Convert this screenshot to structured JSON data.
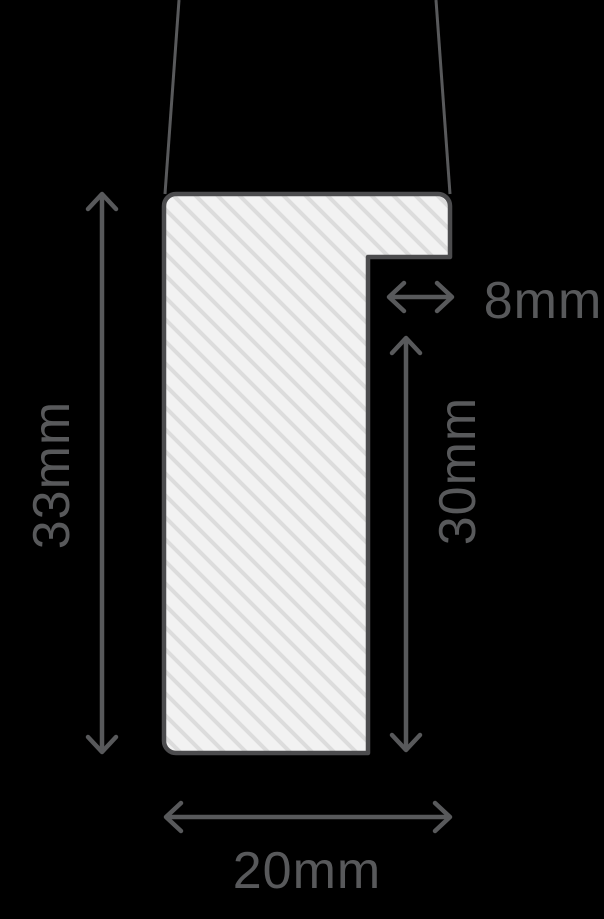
{
  "page": {
    "background_color": "#000000"
  },
  "diagram": {
    "name": "frame-moulding-profile-cross-section",
    "profile": {
      "fill_color": "#f2f2f2",
      "hatch_color": "#dcdcdc",
      "outline_color": "#4c4c4e",
      "hatch_direction": "diagonal-backslash"
    },
    "dimension_color": "#58595b",
    "dimensions": {
      "overall_height": {
        "label": "33mm",
        "orientation": "vertical-left"
      },
      "rebate_width": {
        "label": "8mm",
        "orientation": "horizontal-right"
      },
      "rebate_height": {
        "label": "30mm",
        "orientation": "vertical-right"
      },
      "overall_width": {
        "label": "20mm",
        "orientation": "horizontal-bottom"
      }
    }
  }
}
